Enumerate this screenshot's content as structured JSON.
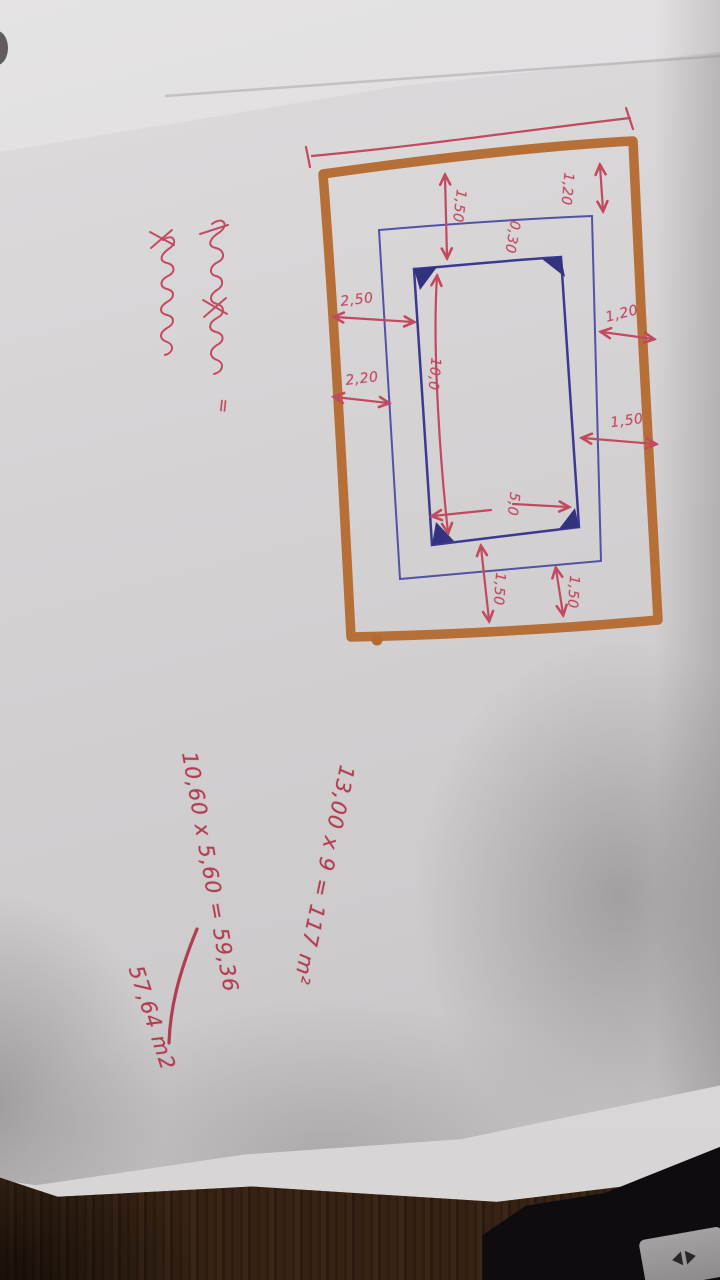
{
  "photo": {
    "subject": "photograph of a hand-drawn swimming-pool deck sketch on paper, lying on a wooden floor",
    "paper_color": "#d3d0d2",
    "floor_material": "wood-planks",
    "device_color": "#141014"
  },
  "sketch": {
    "marker_brown": "#b5692f",
    "ink_blue": "#3f3f98",
    "ink_red": "#c2495f",
    "dim_top_center": "1,50",
    "dim_top_right": "1,20",
    "dim_border_gap": "0,30",
    "dim_left_to_pool": "2,50",
    "dim_left_to_border": "2,20",
    "dim_pool_length": "10,0",
    "dim_right_outer": "1,20",
    "dim_right_inner": "1,50",
    "dim_pool_width": "5,0",
    "dim_bottom_left": "1,50",
    "dim_bottom_right": "1,50",
    "equals_sign": "="
  },
  "calculations": {
    "line1": "13,00 x 9 = 117 m²",
    "line2": "10,60 x 5,60 = 59,36",
    "line3": "57,64 m2"
  },
  "cursive_note": {
    "line1": "(illegible red cursive handwriting)",
    "line2": "(illegible red cursive handwriting)"
  }
}
